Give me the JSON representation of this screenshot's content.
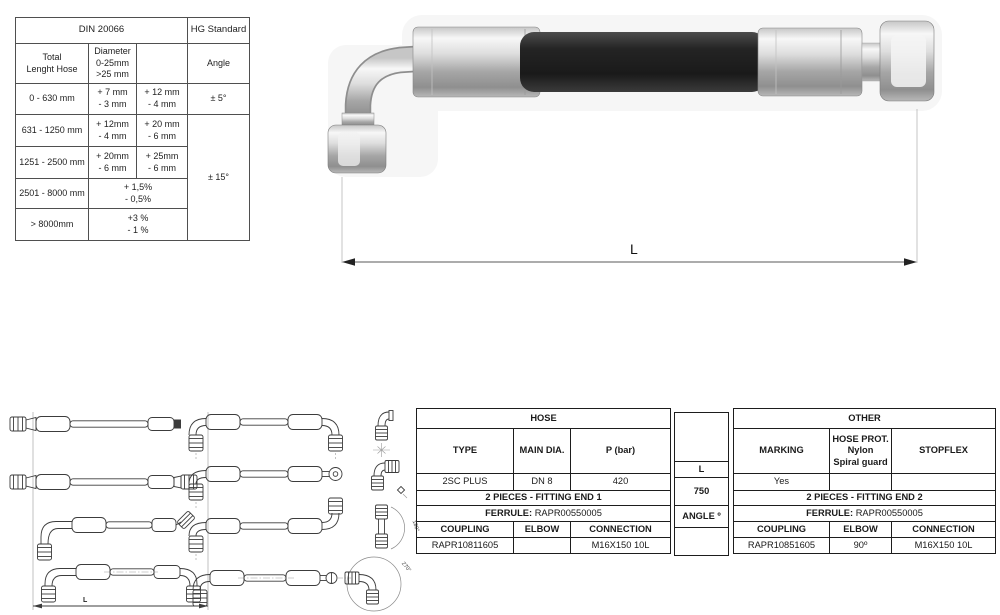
{
  "tolerance_table": {
    "din_title": "DIN 20066",
    "hg_title": "HG Standard",
    "col1_lines": [
      "Total",
      "Lenght Hose"
    ],
    "col2_lines": [
      "Diameter",
      "0-25mm",
      ">25 mm"
    ],
    "angle_header": "Angle",
    "angle_small": "± 5°",
    "angle_large": "± 15°",
    "rows": [
      {
        "range": "0 - 630 mm",
        "d1": [
          "+ 7 mm",
          "- 3 mm"
        ],
        "d2": [
          "+ 12 mm",
          "- 4 mm"
        ]
      },
      {
        "range": "631 - 1250 mm",
        "d1": [
          "+ 12mm",
          "- 4 mm"
        ],
        "d2": [
          "+ 20 mm",
          "- 6 mm"
        ]
      },
      {
        "range": "1251 - 2500 mm",
        "d1": [
          "+ 20mm",
          "- 6 mm"
        ],
        "d2": [
          "+ 25mm",
          "- 6 mm"
        ]
      },
      {
        "range": "2501 - 8000 mm",
        "combined": [
          "+ 1,5%",
          "- 0,5%"
        ]
      },
      {
        "range": "> 8000mm",
        "combined": [
          "+3 %",
          "- 1 %"
        ]
      }
    ]
  },
  "photo": {
    "dimension_label": "L"
  },
  "drawings": {
    "dimension_label": "L",
    "angle_labels": [
      "180°",
      "270°"
    ]
  },
  "spec_table": {
    "hose": {
      "title": "HOSE",
      "col_headers": [
        "TYPE",
        "MAIN DIA.",
        "P (bar)"
      ],
      "values": [
        "2SC PLUS",
        "DN 8",
        "420"
      ],
      "fitting_title": "2 PIECES - FITTING END 1",
      "ferrule_label": "FERRULE:",
      "ferrule_value": "RAPR00550005",
      "bottom_headers": [
        "COUPLING",
        "ELBOW",
        "CONNECTION"
      ],
      "bottom_values": [
        "RAPR10811605",
        "",
        "M16X150 10L"
      ]
    },
    "dims": {
      "l_label": "L",
      "l_value": "750",
      "angle_label": "ANGLE º",
      "angle_value": ""
    },
    "other": {
      "title": "OTHER",
      "marking_header": "MARKING",
      "hose_prot_lines": [
        "HOSE PROT.",
        "Nylon",
        "Spiral guard"
      ],
      "stopflex_header": "STOPFLEX",
      "values": [
        "Yes",
        "",
        ""
      ],
      "fitting_title": "2 PIECES - FITTING END 2",
      "ferrule_label": "FERRULE:",
      "ferrule_value": "RAPR00550005",
      "bottom_headers": [
        "COUPLING",
        "ELBOW",
        "CONNECTION"
      ],
      "bottom_values": [
        "RAPR10851605",
        "90º",
        "M16X150 10L"
      ]
    }
  }
}
